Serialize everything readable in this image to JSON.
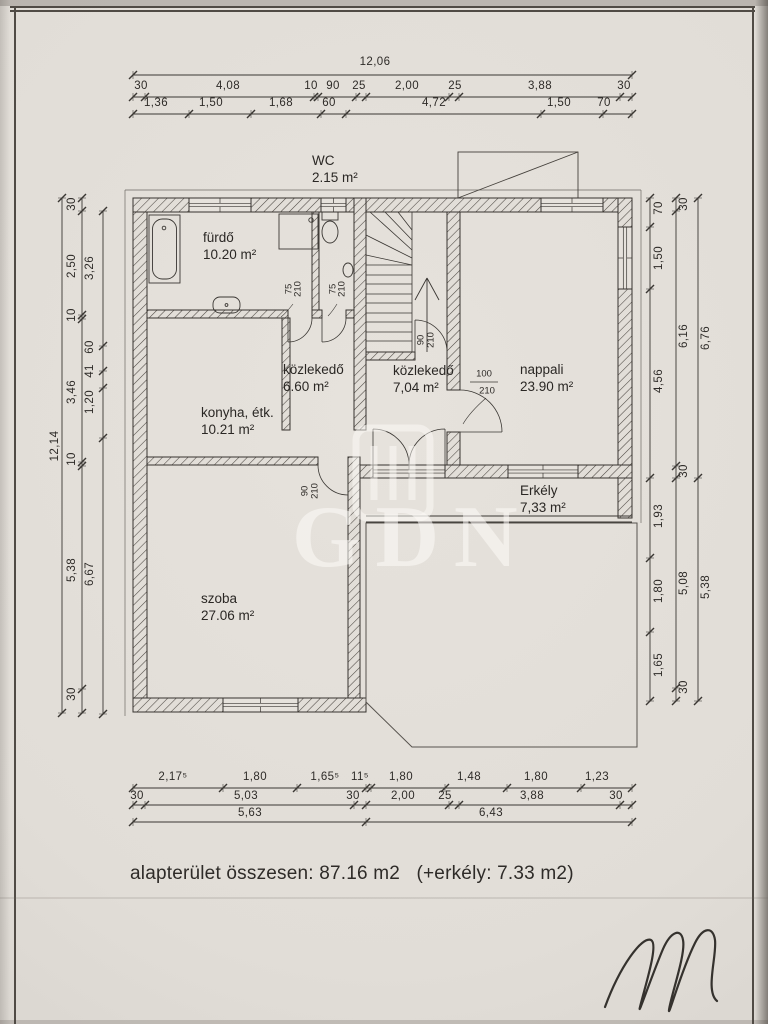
{
  "rooms": [
    {
      "name": "WC",
      "area": "2.15 m²"
    },
    {
      "name": "fürdő",
      "area": "10.20 m²"
    },
    {
      "name": "közlekedő",
      "area": "6.60 m²"
    },
    {
      "name": "közlekedő",
      "area": "7,04 m²"
    },
    {
      "name": "nappali",
      "area": "23.90 m²"
    },
    {
      "name": "konyha, étk.",
      "area": "10.21 m²"
    },
    {
      "name": "Erkély",
      "area": "7,33 m²"
    },
    {
      "name": "szoba",
      "area": "27.06 m²"
    }
  ],
  "dims": {
    "top": {
      "total": "12,06",
      "row2": [
        "30",
        "4,08",
        "10",
        "90",
        "25",
        "2,00",
        "25",
        "3,88",
        "30"
      ],
      "row3": [
        "1,36",
        "1,50",
        "1,68",
        "60",
        "4,72",
        "1,50",
        "70"
      ]
    },
    "left": {
      "total": "12,14",
      "chain": [
        "30",
        "2,50",
        "10",
        "3,46",
        "10",
        "5,38",
        "30"
      ],
      "inner": [
        "3,26",
        "60",
        "41",
        "1,20",
        "6,67"
      ]
    },
    "right": {
      "inner": [
        "70",
        "1,50",
        "4,56",
        "1,93",
        "1,80",
        "1,65"
      ],
      "middle": [
        "30",
        "6,16",
        "30",
        "5,08",
        "30"
      ],
      "outer": [
        "6,76",
        "5,38"
      ]
    },
    "bottom": {
      "row1": [
        "2,17⁵",
        "1,80",
        "1,65⁵",
        "11⁵",
        "1,80",
        "1,48",
        "1,80",
        "1,23"
      ],
      "row2": [
        "30",
        "5,03",
        "30",
        "2,00",
        "25",
        "3,88",
        "30"
      ],
      "row3": [
        "5,63",
        "6,43"
      ]
    }
  },
  "doors": {
    "furdo": [
      "75",
      "210"
    ],
    "wc": [
      "75",
      "210"
    ],
    "stairs": [
      "90",
      "210"
    ],
    "szoba": [
      "90",
      "210"
    ],
    "nappali": [
      "100",
      "210"
    ]
  },
  "footer": {
    "text": "alapterület összesen: 87.16 m2   (+erkély: 7.33 m2)"
  },
  "watermark": {
    "text": "GDN"
  }
}
